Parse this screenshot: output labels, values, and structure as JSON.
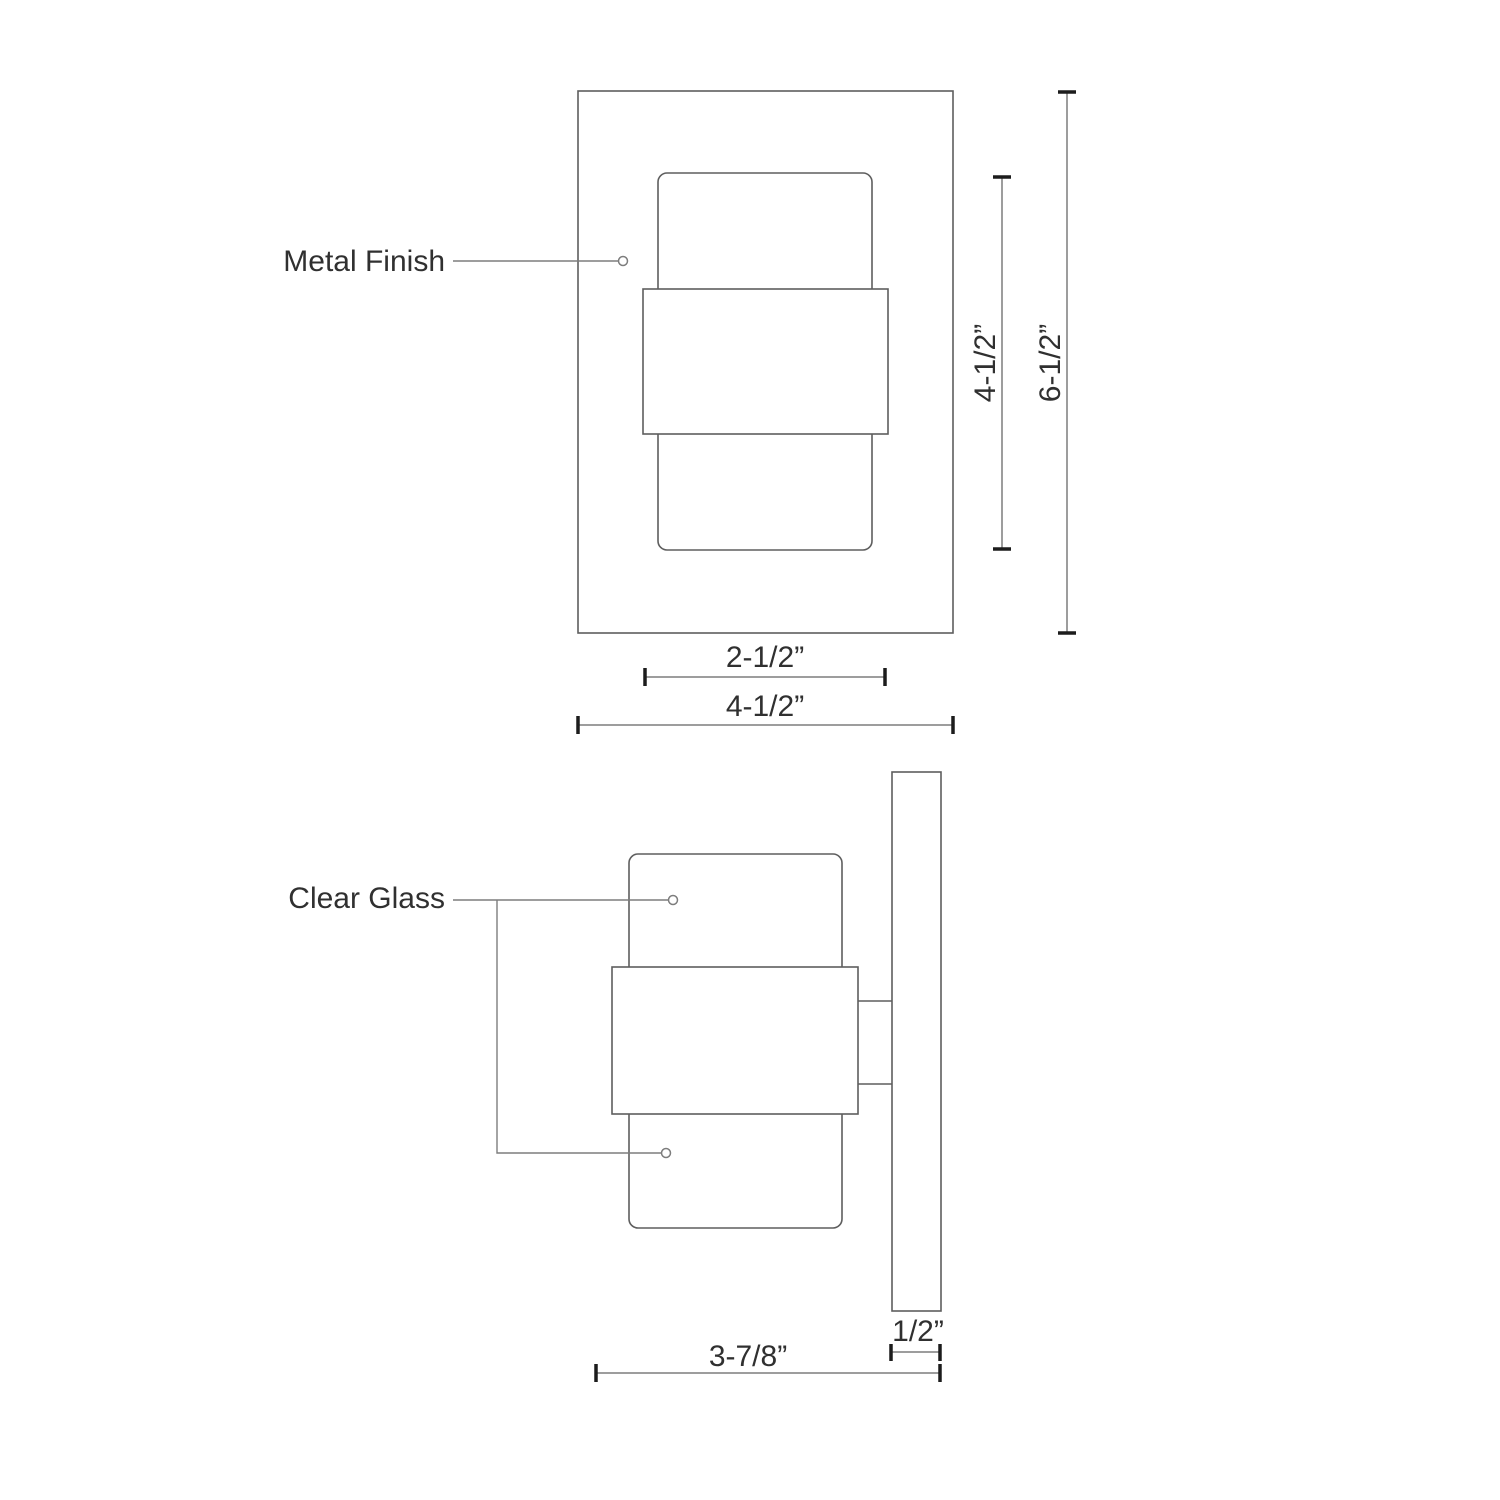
{
  "drawing": {
    "annotations": {
      "metal_finish": "Metal Finish",
      "clear_glass": "Clear Glass"
    },
    "front_view": {
      "glass_height": "4-1/2”",
      "overall_height": "6-1/2”",
      "inner_width": "2-1/2”",
      "overall_width": "4-1/2”"
    },
    "side_view": {
      "overall_depth": "3-7/8”",
      "backplate_thickness": "1/2”"
    }
  },
  "colors": {
    "line": "#5e5e5e",
    "dim": "#7d7d7d",
    "tick": "#1c1c1c",
    "text": "#303030",
    "bg": "#ffffff"
  }
}
